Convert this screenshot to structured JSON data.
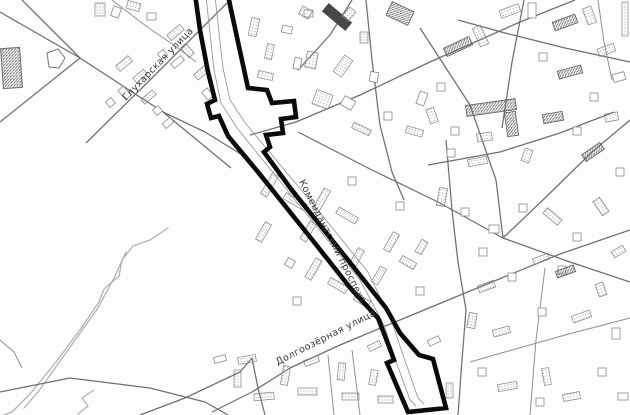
{
  "map": {
    "width": 630,
    "height": 415,
    "colors": {
      "paper": "#fdfdfd",
      "road_major": "#6f6f6f",
      "road_minor": "#8f8f8f",
      "stream": "#b2b2b2",
      "building_stroke": "#858585",
      "building_dark_fill": "#474747",
      "route": "#0a0a0a",
      "label": "#383838"
    },
    "street_labels": [
      {
        "id": "glukharskaya",
        "text": "Глухарская улица",
        "x": 160,
        "y": 66,
        "rotate": -46,
        "font_size": 9.5
      },
      {
        "id": "komendantsky",
        "text": "Комендантский проспект",
        "x": 330,
        "y": 243,
        "rotate": 63,
        "font_size": 9.5
      },
      {
        "id": "dolgoozernaya",
        "text": "Долгоозёрная улица",
        "x": 327,
        "y": 340,
        "rotate": -27,
        "font_size": 9.5
      }
    ],
    "route": {
      "stroke_width": 4.6,
      "outline_path": "M 195,-6 L 200,30 L 208,72 L 215,100 L 207,104 L 211,118 L 219,116 L 228,136 L 258,172 L 310,237 L 352,290 L 378,318 L 390,349 L 394,360 L 387,363 L 408,412 L 446,408 L 433,359 L 419,355 L 400,333 L 386,308 L 344,255 L 291,189 L 272,163 L 264,152 L 270,147 L 266,135 L 283,133 L 281,119 L 296,117 L 294,101 L 272,103 L 267,90 L 248,88 L 238,42 L 230,5 L 228,-6 Z",
      "inner_lines": [
        "M 206,-4 L 214,70 L 221,103 L 237,128 L 300,206 L 360,280 L 384,325 L 394,356 L 410,400 L 416,406",
        "M 215,-4 L 223,68 L 230,100 L 246,124 L 308,198 L 368,272 L 392,322 L 402,352 L 418,398 L 424,404"
      ]
    },
    "roads": {
      "major": [
        "0,12 80,58 163,112 231,168",
        "22,0 80,58",
        "0,122 80,58",
        "86,143 150,80 212,18 230,0",
        "163,112 205,132 247,158",
        "250,135 296,122 360,95 430,62 520,22 575,0",
        "298,70 330,35 352,0",
        "366,0 372,60 380,125 392,172 404,200",
        "446,140 452,210 458,262 466,310 462,360 458,415",
        "298,132 372,170 438,202 503,238",
        "420,28 470,105 496,180 503,238",
        "503,238 570,262 630,282",
        "503,238 545,198 592,152 630,120",
        "428,165 500,152 560,133 614,112",
        "212,412 252,392 290,368 340,345 383,327 470,291 560,254 630,230",
        "140,415 185,398 240,372 252,358",
        "252,358 258,388 265,415",
        "0,392 70,378 150,388 205,402 228,415",
        "524,0 512,62 502,128",
        "630,62 565,48 505,33 458,20"
      ],
      "minor": [
        "112,0 146,26 178,48 196,62",
        "328,355 334,415",
        "352,350 360,415",
        "545,268 536,340 530,415",
        "630,318 565,335 505,352 470,362",
        "598,0 604,42 612,80",
        "0,340 14,352 22,368"
      ],
      "streams": [
        "168,228 150,240 133,246 122,260 119,276 104,289 99,302 82,327 56,362 30,394 12,412 4,415",
        "126,252 114,278 98,308 68,350 38,392 24,408",
        "94,390 82,398 88,406 78,414"
      ]
    },
    "buildings": [
      [
        95,
        3,
        10,
        13,
        0,
        "h"
      ],
      [
        112,
        7,
        8,
        10,
        20,
        "o"
      ],
      [
        127,
        2,
        13,
        8,
        15,
        "h"
      ],
      [
        147,
        13,
        9,
        7,
        0,
        "o"
      ],
      [
        116,
        60,
        16,
        7,
        -40,
        "h"
      ],
      [
        133,
        73,
        14,
        6,
        -40,
        "h"
      ],
      [
        121,
        87,
        7,
        12,
        -40,
        "o"
      ],
      [
        141,
        94,
        15,
        6,
        -40,
        "h"
      ],
      [
        154,
        107,
        7,
        7,
        -40,
        "o"
      ],
      [
        107,
        99,
        7,
        7,
        -40,
        "o"
      ],
      [
        163,
        120,
        10,
        6,
        -40,
        "o"
      ],
      [
        167,
        29,
        17,
        7,
        -40,
        "h"
      ],
      [
        184,
        44,
        7,
        13,
        -40,
        "h"
      ],
      [
        171,
        59,
        13,
        6,
        -40,
        "o"
      ],
      [
        194,
        69,
        15,
        7,
        -40,
        "h"
      ],
      [
        204,
        89,
        7,
        10,
        -40,
        "o"
      ],
      [
        159,
        51,
        7,
        7,
        -40,
        "o"
      ],
      [
        250,
        18,
        8,
        18,
        12,
        "h"
      ],
      [
        266,
        44,
        7,
        15,
        12,
        "h"
      ],
      [
        282,
        26,
        10,
        7,
        12,
        "o"
      ],
      [
        258,
        72,
        15,
        7,
        12,
        "h"
      ],
      [
        294,
        58,
        7,
        11,
        12,
        "o"
      ],
      [
        304,
        10,
        9,
        7,
        0,
        "o"
      ],
      [
        322,
        12,
        30,
        10,
        40,
        "d"
      ],
      [
        306,
        52,
        11,
        16,
        10,
        "h"
      ],
      [
        338,
        56,
        10,
        20,
        35,
        "h"
      ],
      [
        300,
        8,
        11,
        9,
        30,
        "h"
      ],
      [
        360,
        32,
        8,
        11,
        0,
        "h"
      ],
      [
        388,
        6,
        24,
        15,
        25,
        "H"
      ],
      [
        314,
        92,
        17,
        15,
        20,
        "h"
      ],
      [
        342,
        98,
        12,
        10,
        30,
        "o"
      ],
      [
        370,
        72,
        8,
        10,
        10,
        "o"
      ],
      [
        352,
        126,
        19,
        6,
        25,
        "h"
      ],
      [
        384,
        112,
        8,
        8,
        0,
        "o"
      ],
      [
        406,
        128,
        17,
        7,
        15,
        "h"
      ],
      [
        418,
        92,
        8,
        13,
        20,
        "o"
      ],
      [
        345,
        8,
        8,
        12,
        40,
        "h"
      ],
      [
        444,
        42,
        28,
        9,
        -25,
        "H"
      ],
      [
        476,
        26,
        9,
        20,
        -25,
        "h"
      ],
      [
        500,
        7,
        20,
        8,
        -20,
        "h"
      ],
      [
        528,
        3,
        8,
        15,
        0,
        "o"
      ],
      [
        553,
        18,
        24,
        9,
        -20,
        "H"
      ],
      [
        585,
        7,
        9,
        17,
        -20,
        "h"
      ],
      [
        539,
        53,
        8,
        8,
        0,
        "o"
      ],
      [
        558,
        68,
        24,
        8,
        -15,
        "H"
      ],
      [
        598,
        46,
        17,
        8,
        -20,
        "h"
      ],
      [
        613,
        73,
        12,
        8,
        -15,
        "o"
      ],
      [
        590,
        93,
        8,
        8,
        0,
        "o"
      ],
      [
        437,
        83,
        8,
        8,
        0,
        "o"
      ],
      [
        428,
        108,
        8,
        15,
        -20,
        "h"
      ],
      [
        466,
        102,
        50,
        11,
        -8,
        "H"
      ],
      [
        506,
        112,
        11,
        24,
        -8,
        "H"
      ],
      [
        477,
        133,
        15,
        8,
        -8,
        "h"
      ],
      [
        451,
        127,
        8,
        8,
        0,
        "o"
      ],
      [
        543,
        113,
        20,
        9,
        -10,
        "H"
      ],
      [
        573,
        127,
        8,
        8,
        0,
        "o"
      ],
      [
        605,
        113,
        13,
        8,
        -10,
        "h"
      ],
      [
        622,
        2,
        6,
        34,
        0,
        "h"
      ],
      [
        447,
        149,
        8,
        8,
        0,
        "o"
      ],
      [
        468,
        158,
        19,
        7,
        -10,
        "h"
      ],
      [
        523,
        149,
        8,
        13,
        20,
        "h"
      ],
      [
        582,
        148,
        22,
        8,
        -35,
        "H"
      ],
      [
        616,
        168,
        8,
        8,
        0,
        "o"
      ],
      [
        438,
        188,
        8,
        18,
        10,
        "h"
      ],
      [
        461,
        208,
        8,
        8,
        0,
        "o"
      ],
      [
        519,
        204,
        8,
        8,
        0,
        "o"
      ],
      [
        543,
        213,
        19,
        7,
        40,
        "h"
      ],
      [
        597,
        198,
        8,
        17,
        -35,
        "h"
      ],
      [
        573,
        233,
        8,
        8,
        0,
        "o"
      ],
      [
        612,
        248,
        13,
        7,
        -30,
        "h"
      ],
      [
        479,
        248,
        8,
        8,
        0,
        "o"
      ],
      [
        489,
        225,
        10,
        8,
        0,
        "o"
      ],
      [
        533,
        256,
        16,
        6,
        -20,
        "h"
      ],
      [
        558,
        266,
        8,
        8,
        0,
        "o"
      ],
      [
        266,
        173,
        7,
        24,
        30,
        "h"
      ],
      [
        283,
        198,
        24,
        7,
        30,
        "h"
      ],
      [
        260,
        222,
        7,
        20,
        30,
        "h"
      ],
      [
        298,
        228,
        20,
        7,
        -60,
        "h"
      ],
      [
        318,
        188,
        7,
        24,
        30,
        "h"
      ],
      [
        336,
        212,
        22,
        7,
        30,
        "h"
      ],
      [
        310,
        258,
        7,
        22,
        30,
        "h"
      ],
      [
        328,
        282,
        20,
        7,
        30,
        "h"
      ],
      [
        353,
        248,
        7,
        20,
        30,
        "h"
      ],
      [
        370,
        272,
        18,
        7,
        -60,
        "h"
      ],
      [
        388,
        232,
        7,
        20,
        30,
        "h"
      ],
      [
        400,
        259,
        16,
        7,
        30,
        "h"
      ],
      [
        354,
        297,
        16,
        7,
        30,
        "h"
      ],
      [
        286,
        259,
        8,
        8,
        30,
        "o"
      ],
      [
        348,
        177,
        8,
        8,
        0,
        "o"
      ],
      [
        396,
        202,
        8,
        8,
        0,
        "o"
      ],
      [
        416,
        287,
        8,
        8,
        0,
        "o"
      ],
      [
        293,
        297,
        8,
        8,
        0,
        "o"
      ],
      [
        418,
        240,
        7,
        14,
        30,
        "h"
      ],
      [
        238,
        356,
        18,
        7,
        -10,
        "h"
      ],
      [
        234,
        370,
        7,
        17,
        0,
        "h"
      ],
      [
        254,
        393,
        20,
        7,
        -5,
        "h"
      ],
      [
        282,
        366,
        7,
        19,
        10,
        "h"
      ],
      [
        298,
        388,
        19,
        7,
        0,
        "h"
      ],
      [
        304,
        358,
        15,
        6,
        -20,
        "h"
      ],
      [
        338,
        363,
        7,
        17,
        5,
        "h"
      ],
      [
        342,
        393,
        17,
        7,
        0,
        "h"
      ],
      [
        370,
        370,
        7,
        15,
        10,
        "h"
      ],
      [
        378,
        396,
        15,
        7,
        0,
        "h"
      ],
      [
        368,
        343,
        13,
        6,
        -25,
        "h"
      ],
      [
        214,
        356,
        12,
        6,
        -15,
        "o"
      ],
      [
        446,
        383,
        7,
        15,
        0,
        "h"
      ],
      [
        428,
        338,
        12,
        6,
        -25,
        "o"
      ],
      [
        478,
        283,
        17,
        7,
        -20,
        "h"
      ],
      [
        508,
        273,
        8,
        8,
        0,
        "o"
      ],
      [
        556,
        268,
        19,
        7,
        -20,
        "H"
      ],
      [
        597,
        283,
        8,
        13,
        -20,
        "h"
      ],
      [
        468,
        313,
        8,
        15,
        10,
        "h"
      ],
      [
        493,
        328,
        17,
        7,
        -15,
        "h"
      ],
      [
        538,
        308,
        8,
        8,
        0,
        "o"
      ],
      [
        572,
        313,
        19,
        7,
        -20,
        "h"
      ],
      [
        612,
        328,
        8,
        11,
        0,
        "o"
      ],
      [
        478,
        368,
        8,
        8,
        0,
        "o"
      ],
      [
        498,
        383,
        19,
        7,
        -10,
        "h"
      ],
      [
        543,
        368,
        7,
        17,
        -10,
        "h"
      ],
      [
        563,
        393,
        17,
        7,
        -10,
        "h"
      ],
      [
        598,
        368,
        8,
        8,
        0,
        "o"
      ],
      [
        618,
        393,
        10,
        7,
        0,
        "o"
      ],
      [
        536,
        398,
        8,
        8,
        0,
        "o"
      ]
    ],
    "landmarks": {
      "pentagon_points": "47,53 58,49 65,58 59,68 49,67",
      "basin": {
        "x": 2,
        "y": 48,
        "w": 19,
        "h": 40,
        "rotate": -4
      }
    }
  }
}
